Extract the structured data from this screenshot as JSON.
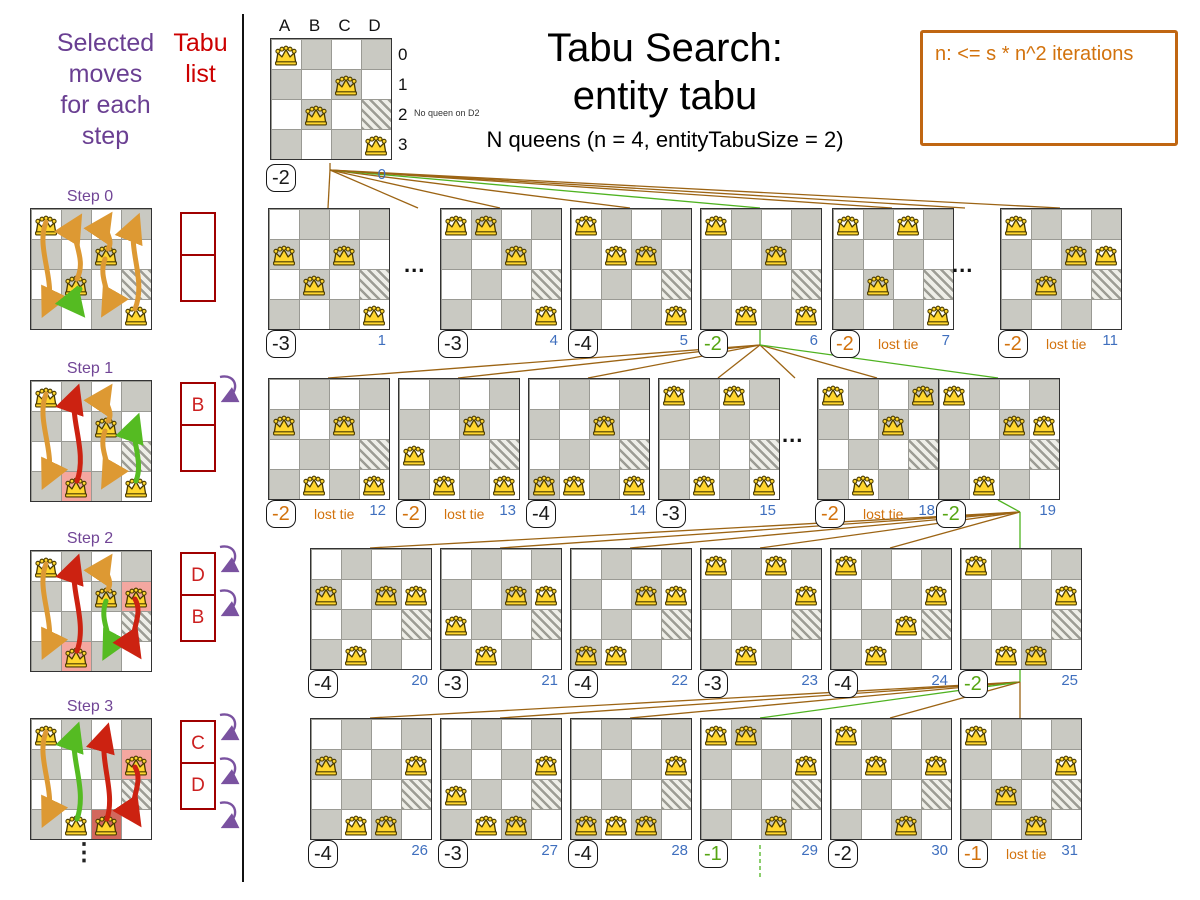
{
  "header": {
    "title_line1": "Tabu Search:",
    "title_line2": "entity tabu",
    "subtitle": "N queens (n = 4, entityTabuSize = 2)",
    "note": "n: <= s * n^2 iterations"
  },
  "left_panel": {
    "moves_label_lines": [
      "Selected",
      "moves",
      "for each",
      "step"
    ],
    "tabu_label_lines": [
      "Tabu",
      "list"
    ],
    "ellipsis": "⋮"
  },
  "root_board": {
    "x": 270,
    "y": 38,
    "col_headers": [
      "A",
      "B",
      "C",
      "D"
    ],
    "row_headers": [
      "0",
      "1",
      "2",
      "3"
    ],
    "annotation": "No queen on D2",
    "score": "-2",
    "tone": "black",
    "index": "0",
    "queens": [
      [
        0,
        0
      ],
      [
        2,
        1
      ],
      [
        1,
        2
      ],
      [
        3,
        3
      ]
    ]
  },
  "lost_tie_label": "lost tie",
  "boards": [
    {
      "index": "1",
      "x": 268,
      "y": 208,
      "score": "-3",
      "tone": "black",
      "lost_tie": false,
      "queens": [
        [
          0,
          1
        ],
        [
          2,
          1
        ],
        [
          1,
          2
        ],
        [
          3,
          3
        ]
      ]
    },
    {
      "index": "4",
      "x": 440,
      "y": 208,
      "score": "-3",
      "tone": "black",
      "lost_tie": false,
      "queens": [
        [
          0,
          0
        ],
        [
          1,
          0
        ],
        [
          2,
          1
        ],
        [
          3,
          3
        ]
      ]
    },
    {
      "index": "5",
      "x": 570,
      "y": 208,
      "score": "-4",
      "tone": "black",
      "lost_tie": false,
      "queens": [
        [
          0,
          0
        ],
        [
          1,
          1
        ],
        [
          2,
          1
        ],
        [
          3,
          3
        ]
      ]
    },
    {
      "index": "6",
      "x": 700,
      "y": 208,
      "score": "-2",
      "tone": "green",
      "lost_tie": false,
      "queens": [
        [
          0,
          0
        ],
        [
          2,
          1
        ],
        [
          1,
          3
        ],
        [
          3,
          3
        ]
      ]
    },
    {
      "index": "7",
      "x": 832,
      "y": 208,
      "score": "-2",
      "tone": "orange",
      "lost_tie": true,
      "queens": [
        [
          0,
          0
        ],
        [
          2,
          0
        ],
        [
          1,
          2
        ],
        [
          3,
          3
        ]
      ]
    },
    {
      "index": "11",
      "x": 1000,
      "y": 208,
      "score": "-2",
      "tone": "orange",
      "lost_tie": true,
      "queens": [
        [
          0,
          0
        ],
        [
          2,
          1
        ],
        [
          3,
          1
        ],
        [
          1,
          2
        ]
      ]
    },
    {
      "index": "12",
      "x": 268,
      "y": 378,
      "score": "-2",
      "tone": "orange",
      "lost_tie": true,
      "queens": [
        [
          0,
          1
        ],
        [
          2,
          1
        ],
        [
          1,
          3
        ],
        [
          3,
          3
        ]
      ]
    },
    {
      "index": "13",
      "x": 398,
      "y": 378,
      "score": "-2",
      "tone": "orange",
      "lost_tie": true,
      "queens": [
        [
          0,
          2
        ],
        [
          2,
          1
        ],
        [
          1,
          3
        ],
        [
          3,
          3
        ]
      ]
    },
    {
      "index": "14",
      "x": 528,
      "y": 378,
      "score": "-4",
      "tone": "black",
      "lost_tie": false,
      "queens": [
        [
          0,
          3
        ],
        [
          2,
          1
        ],
        [
          1,
          3
        ],
        [
          3,
          3
        ]
      ]
    },
    {
      "index": "15",
      "x": 658,
      "y": 378,
      "score": "-3",
      "tone": "black",
      "lost_tie": false,
      "queens": [
        [
          0,
          0
        ],
        [
          2,
          0
        ],
        [
          1,
          3
        ],
        [
          3,
          3
        ]
      ]
    },
    {
      "index": "18",
      "x": 817,
      "y": 378,
      "score": "-2",
      "tone": "orange",
      "lost_tie": true,
      "queens": [
        [
          0,
          0
        ],
        [
          3,
          0
        ],
        [
          2,
          1
        ],
        [
          1,
          3
        ]
      ]
    },
    {
      "index": "19",
      "x": 938,
      "y": 378,
      "score": "-2",
      "tone": "green",
      "lost_tie": false,
      "queens": [
        [
          0,
          0
        ],
        [
          2,
          1
        ],
        [
          3,
          1
        ],
        [
          1,
          3
        ]
      ]
    },
    {
      "index": "20",
      "x": 310,
      "y": 548,
      "score": "-4",
      "tone": "black",
      "lost_tie": false,
      "queens": [
        [
          0,
          1
        ],
        [
          2,
          1
        ],
        [
          3,
          1
        ],
        [
          1,
          3
        ]
      ]
    },
    {
      "index": "21",
      "x": 440,
      "y": 548,
      "score": "-3",
      "tone": "black",
      "lost_tie": false,
      "queens": [
        [
          0,
          2
        ],
        [
          2,
          1
        ],
        [
          3,
          1
        ],
        [
          1,
          3
        ]
      ]
    },
    {
      "index": "22",
      "x": 570,
      "y": 548,
      "score": "-4",
      "tone": "black",
      "lost_tie": false,
      "queens": [
        [
          0,
          3
        ],
        [
          2,
          1
        ],
        [
          3,
          1
        ],
        [
          1,
          3
        ]
      ]
    },
    {
      "index": "23",
      "x": 700,
      "y": 548,
      "score": "-3",
      "tone": "black",
      "lost_tie": false,
      "queens": [
        [
          0,
          0
        ],
        [
          2,
          0
        ],
        [
          3,
          1
        ],
        [
          1,
          3
        ]
      ]
    },
    {
      "index": "24",
      "x": 830,
      "y": 548,
      "score": "-4",
      "tone": "black",
      "lost_tie": false,
      "queens": [
        [
          0,
          0
        ],
        [
          2,
          2
        ],
        [
          3,
          1
        ],
        [
          1,
          3
        ]
      ]
    },
    {
      "index": "25",
      "x": 960,
      "y": 548,
      "score": "-2",
      "tone": "green",
      "lost_tie": false,
      "queens": [
        [
          0,
          0
        ],
        [
          2,
          3
        ],
        [
          3,
          1
        ],
        [
          1,
          3
        ]
      ]
    },
    {
      "index": "26",
      "x": 310,
      "y": 718,
      "score": "-4",
      "tone": "black",
      "lost_tie": false,
      "queens": [
        [
          0,
          1
        ],
        [
          3,
          1
        ],
        [
          1,
          3
        ],
        [
          2,
          3
        ]
      ]
    },
    {
      "index": "27",
      "x": 440,
      "y": 718,
      "score": "-3",
      "tone": "black",
      "lost_tie": false,
      "queens": [
        [
          0,
          2
        ],
        [
          3,
          1
        ],
        [
          1,
          3
        ],
        [
          2,
          3
        ]
      ]
    },
    {
      "index": "28",
      "x": 570,
      "y": 718,
      "score": "-4",
      "tone": "black",
      "lost_tie": false,
      "queens": [
        [
          0,
          3
        ],
        [
          3,
          1
        ],
        [
          1,
          3
        ],
        [
          2,
          3
        ]
      ]
    },
    {
      "index": "29",
      "x": 700,
      "y": 718,
      "score": "-1",
      "tone": "green",
      "lost_tie": false,
      "queens": [
        [
          0,
          0
        ],
        [
          1,
          0
        ],
        [
          3,
          1
        ],
        [
          2,
          3
        ]
      ]
    },
    {
      "index": "30",
      "x": 830,
      "y": 718,
      "score": "-2",
      "tone": "black",
      "lost_tie": false,
      "queens": [
        [
          0,
          0
        ],
        [
          1,
          1
        ],
        [
          3,
          1
        ],
        [
          2,
          3
        ]
      ]
    },
    {
      "index": "31",
      "x": 960,
      "y": 718,
      "score": "-1",
      "tone": "orange",
      "lost_tie": true,
      "queens": [
        [
          0,
          0
        ],
        [
          1,
          2
        ],
        [
          3,
          1
        ],
        [
          2,
          3
        ]
      ]
    }
  ],
  "dots": [
    {
      "x": 404,
      "y": 252,
      "t": "..."
    },
    {
      "x": 952,
      "y": 252,
      "t": "..."
    },
    {
      "x": 782,
      "y": 422,
      "t": "..."
    }
  ],
  "steps": [
    {
      "label": "Step 0",
      "x": 30,
      "y": 208,
      "queens": [
        [
          0,
          0
        ],
        [
          2,
          1
        ],
        [
          1,
          2
        ],
        [
          3,
          3
        ]
      ],
      "highlights": [],
      "arrows": [
        {
          "d": "M15,13 C4,40 27,75 15,100",
          "c": "o"
        },
        {
          "d": "M46,70 C57,48 37,28 46,13",
          "c": "o"
        },
        {
          "d": "M49,80 C41,90 44,96 48,101",
          "c": "g"
        },
        {
          "d": "M77,40 C84,30 70,20 76,11",
          "c": "o"
        },
        {
          "d": "M74,50 C66,70 83,86 75,100",
          "c": "o"
        },
        {
          "d": "M104,100 C116,70 95,38 105,13",
          "c": "o"
        }
      ],
      "tabu": {
        "x": 180,
        "y": 212,
        "slots": [
          "",
          ""
        ]
      },
      "spins": 0
    },
    {
      "label": "Step 1",
      "x": 30,
      "y": 380,
      "queens": [
        [
          0,
          0
        ],
        [
          2,
          1
        ],
        [
          1,
          3
        ],
        [
          3,
          3
        ]
      ],
      "highlights": [
        [
          1,
          3,
          "pink"
        ]
      ],
      "arrows": [
        {
          "d": "M15,13 C4,40 27,75 15,100",
          "c": "o"
        },
        {
          "d": "M46,100 C57,70 37,35 45,12",
          "c": "r"
        },
        {
          "d": "M77,40 C84,30 70,20 76,11",
          "c": "o"
        },
        {
          "d": "M74,50 C66,70 83,86 75,100",
          "c": "o"
        },
        {
          "d": "M105,100 C113,80 99,58 105,41",
          "c": "g"
        }
      ],
      "tabu": {
        "x": 180,
        "y": 382,
        "slots": [
          "B",
          ""
        ]
      },
      "spins": 1
    },
    {
      "label": "Step 2",
      "x": 30,
      "y": 550,
      "queens": [
        [
          0,
          0
        ],
        [
          2,
          1
        ],
        [
          3,
          1
        ],
        [
          1,
          3
        ]
      ],
      "highlights": [
        [
          3,
          1,
          "pink"
        ],
        [
          1,
          3,
          "pink"
        ]
      ],
      "arrows": [
        {
          "d": "M15,13 C4,40 27,75 15,100",
          "c": "o"
        },
        {
          "d": "M46,100 C57,70 37,35 45,12",
          "c": "r"
        },
        {
          "d": "M77,38 C83,28 70,20 76,11",
          "c": "o"
        },
        {
          "d": "M75,50 C67,72 84,86 76,101",
          "c": "g"
        },
        {
          "d": "M104,48 C114,65 95,85 105,100",
          "c": "r"
        }
      ],
      "tabu": {
        "x": 180,
        "y": 552,
        "slots": [
          "D",
          "B"
        ]
      },
      "spins": 2
    },
    {
      "label": "Step 3",
      "x": 30,
      "y": 718,
      "queens": [
        [
          0,
          0
        ],
        [
          3,
          1
        ],
        [
          1,
          3
        ],
        [
          2,
          3
        ]
      ],
      "highlights": [
        [
          3,
          1,
          "pink"
        ],
        [
          2,
          3,
          "dark"
        ]
      ],
      "arrows": [
        {
          "d": "M15,13 C4,40 27,75 15,100",
          "c": "o"
        },
        {
          "d": "M46,100 C57,70 37,35 45,12",
          "c": "g"
        },
        {
          "d": "M76,100 C85,72 67,40 75,13",
          "c": "r"
        },
        {
          "d": "M104,48 C114,65 95,85 105,100",
          "c": "r"
        }
      ],
      "tabu": {
        "x": 180,
        "y": 720,
        "slots": [
          "C",
          "D"
        ]
      },
      "spins": 3
    }
  ],
  "connectors": [
    {
      "x1": 330,
      "y1": 163,
      "x2": 330,
      "y2": 170,
      "c": "b"
    },
    {
      "x1": 330,
      "y1": 170,
      "x2": 328,
      "y2": 208,
      "c": "b"
    },
    {
      "x1": 330,
      "y1": 170,
      "x2": 418,
      "y2": 208,
      "c": "b"
    },
    {
      "x1": 330,
      "y1": 170,
      "x2": 500,
      "y2": 208,
      "c": "b"
    },
    {
      "x1": 330,
      "y1": 170,
      "x2": 630,
      "y2": 208,
      "c": "b"
    },
    {
      "x1": 330,
      "y1": 170,
      "x2": 760,
      "y2": 208,
      "c": "g"
    },
    {
      "x1": 330,
      "y1": 170,
      "x2": 892,
      "y2": 208,
      "c": "b"
    },
    {
      "x1": 330,
      "y1": 170,
      "x2": 965,
      "y2": 208,
      "c": "b"
    },
    {
      "x1": 330,
      "y1": 170,
      "x2": 1060,
      "y2": 208,
      "c": "b"
    },
    {
      "x1": 760,
      "y1": 330,
      "x2": 760,
      "y2": 345,
      "c": "g"
    },
    {
      "x1": 760,
      "y1": 345,
      "x2": 328,
      "y2": 378,
      "c": "b"
    },
    {
      "x1": 760,
      "y1": 345,
      "x2": 458,
      "y2": 378,
      "c": "b"
    },
    {
      "x1": 760,
      "y1": 345,
      "x2": 588,
      "y2": 378,
      "c": "b"
    },
    {
      "x1": 760,
      "y1": 345,
      "x2": 718,
      "y2": 378,
      "c": "b"
    },
    {
      "x1": 760,
      "y1": 345,
      "x2": 795,
      "y2": 378,
      "c": "b"
    },
    {
      "x1": 760,
      "y1": 345,
      "x2": 877,
      "y2": 378,
      "c": "b"
    },
    {
      "x1": 760,
      "y1": 345,
      "x2": 998,
      "y2": 378,
      "c": "g"
    },
    {
      "x1": 998,
      "y1": 500,
      "x2": 1020,
      "y2": 512,
      "c": "g"
    },
    {
      "x1": 1020,
      "y1": 512,
      "x2": 370,
      "y2": 548,
      "c": "b"
    },
    {
      "x1": 1020,
      "y1": 512,
      "x2": 500,
      "y2": 548,
      "c": "b"
    },
    {
      "x1": 1020,
      "y1": 512,
      "x2": 630,
      "y2": 548,
      "c": "b"
    },
    {
      "x1": 1020,
      "y1": 512,
      "x2": 760,
      "y2": 548,
      "c": "b"
    },
    {
      "x1": 1020,
      "y1": 512,
      "x2": 890,
      "y2": 548,
      "c": "b"
    },
    {
      "x1": 1020,
      "y1": 512,
      "x2": 1020,
      "y2": 548,
      "c": "g"
    },
    {
      "x1": 1020,
      "y1": 670,
      "x2": 1020,
      "y2": 682,
      "c": "g"
    },
    {
      "x1": 1020,
      "y1": 682,
      "x2": 370,
      "y2": 718,
      "c": "b"
    },
    {
      "x1": 1020,
      "y1": 682,
      "x2": 500,
      "y2": 718,
      "c": "b"
    },
    {
      "x1": 1020,
      "y1": 682,
      "x2": 630,
      "y2": 718,
      "c": "b"
    },
    {
      "x1": 1020,
      "y1": 682,
      "x2": 760,
      "y2": 718,
      "c": "g"
    },
    {
      "x1": 1020,
      "y1": 682,
      "x2": 890,
      "y2": 718,
      "c": "b"
    },
    {
      "x1": 1020,
      "y1": 682,
      "x2": 1020,
      "y2": 718,
      "c": "b"
    },
    {
      "x1": 760,
      "y1": 845,
      "x2": 760,
      "y2": 880,
      "c": "g",
      "dash": true
    }
  ],
  "colors": {
    "brown_line": "#9c6414",
    "green_line": "#4fb321",
    "arrow_orange": "#dd9933",
    "arrow_red": "#cc2211",
    "arrow_green": "#55bb22",
    "purple": "#7a52a0"
  }
}
